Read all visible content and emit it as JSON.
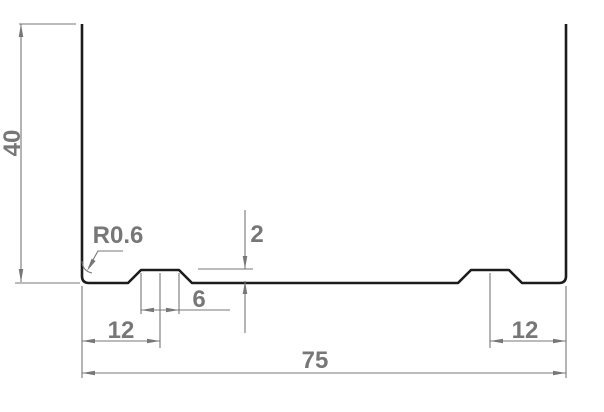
{
  "drawing": {
    "dimensions": {
      "height": "40",
      "overall_width": "75",
      "left_groove_offset": "12",
      "right_groove_offset": "12",
      "groove_width": "6",
      "groove_depth": "2",
      "corner_radius": "R0.6"
    },
    "colors": {
      "profile": "#1c1c1c",
      "dimension": "#777777",
      "background": "#ffffff"
    }
  }
}
